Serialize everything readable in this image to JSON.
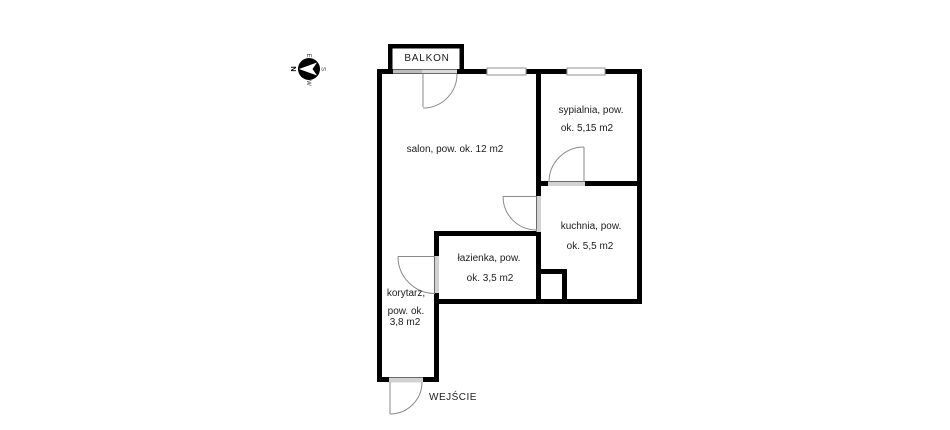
{
  "floorplan": {
    "compass": {
      "north": "N",
      "east": "E",
      "south": "S",
      "west": "W"
    },
    "balcony": {
      "label": "BALKON"
    },
    "entrance": {
      "label": "WEJŚCIE"
    },
    "rooms": {
      "salon": {
        "label": "salon, pow. ok. 12 m2"
      },
      "sypialnia": {
        "name_line": "sypialnia, pow.",
        "area_line": "ok. 5,15 m2"
      },
      "kuchnia": {
        "name_line": "kuchnia, pow.",
        "area_line": "ok. 5,5 m2"
      },
      "lazienka": {
        "name_line": "łazienka, pow.",
        "area_line": "ok. 3,5 m2"
      },
      "korytarz": {
        "name_line": "korytarz,",
        "area_line1": "pow. ok.",
        "area_line2": "3,8 m2"
      }
    },
    "colors": {
      "wall": "#000000",
      "door_opening": "#d2d2d2",
      "door_opening_dark": "#bdbdbd",
      "door_swing": "#8a8a8a",
      "label_text": "#1c1c1c",
      "background": "#ffffff"
    }
  }
}
